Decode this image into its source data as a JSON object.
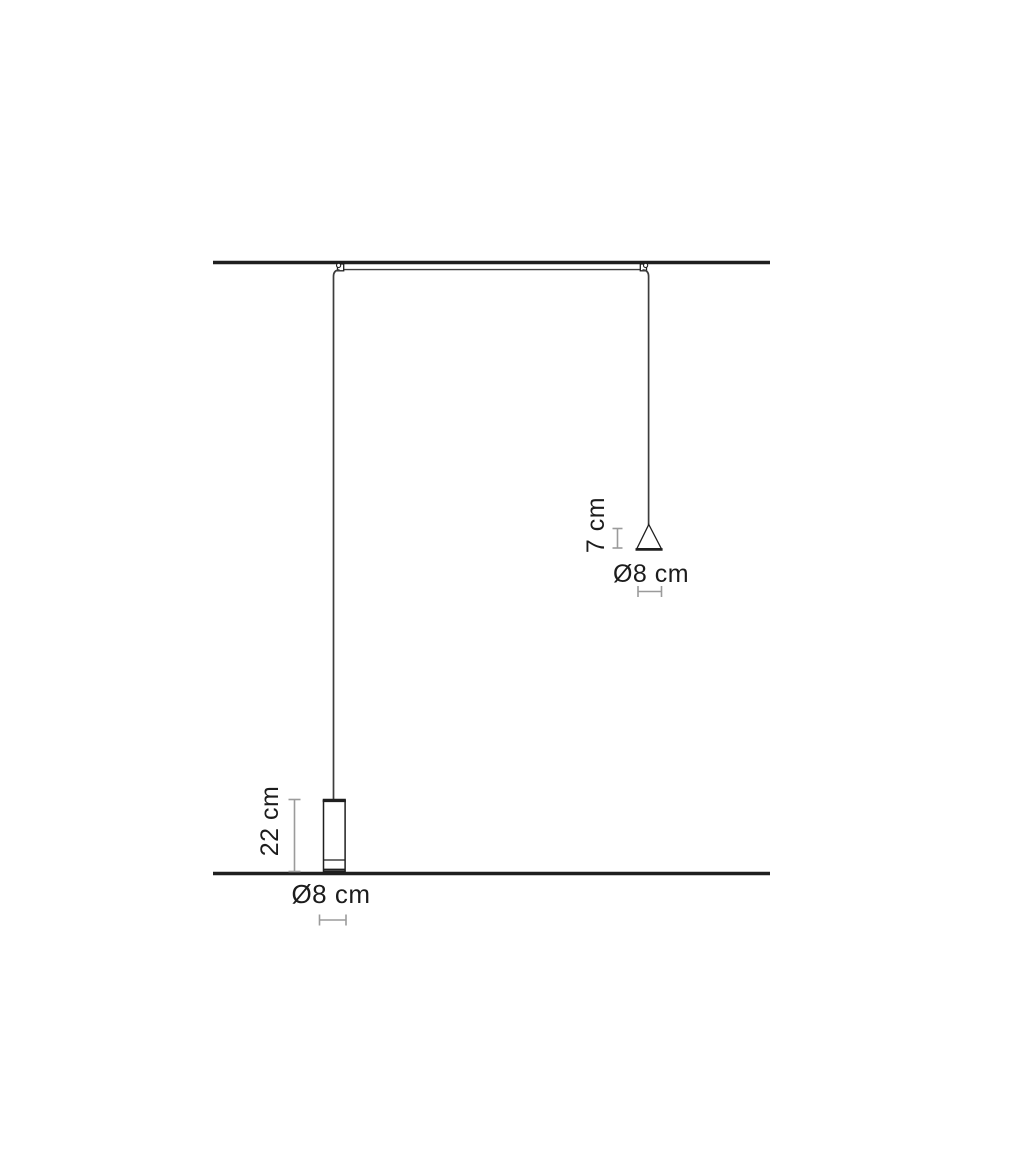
{
  "diagram": {
    "type": "dimension-drawing",
    "labels": {
      "cone_height": "7 cm",
      "cone_diameter": "Ø8 cm",
      "cylinder_height": "22 cm",
      "cylinder_diameter": "Ø8 cm"
    },
    "measurements": {
      "cone": {
        "height_cm": 7,
        "diameter_cm": 8
      },
      "cylinder": {
        "height_cm": 22,
        "diameter_cm": 8
      }
    },
    "colors": {
      "background": "#ffffff",
      "line": "#1f1f1f",
      "cable": "#3d3d3d",
      "dimension": "#9b9b9b",
      "text": "#1c1c1c"
    }
  }
}
